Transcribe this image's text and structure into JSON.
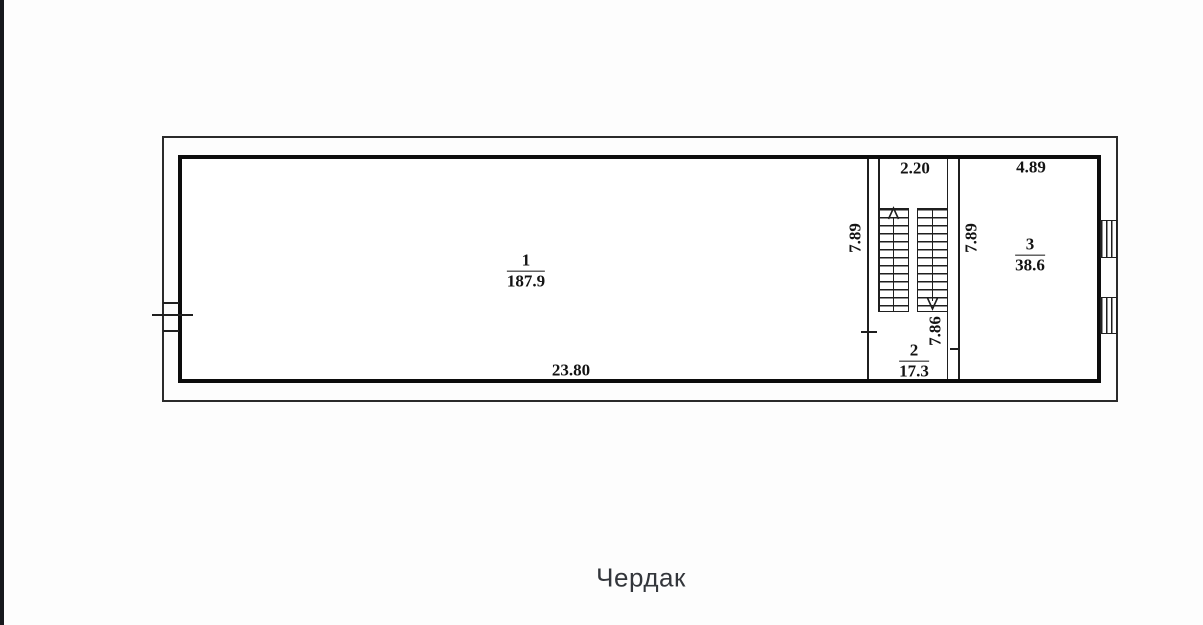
{
  "page": {
    "title_caption": "Чердак"
  },
  "plan": {
    "rooms": [
      {
        "number": "1",
        "area": "187.9"
      },
      {
        "number": "2",
        "area": "17.3"
      },
      {
        "number": "3",
        "area": "38.6"
      }
    ],
    "dimensions": {
      "total_width": "23.80",
      "stair_hall_width": "2.20",
      "room3_width": "4.89",
      "left_depth": "7.89",
      "right_depth": "7.89",
      "room2_depth": "7.86"
    },
    "icons": {
      "stairs_up": "stairs-up-arrow-icon",
      "stairs_down": "stairs-down-arrow-icon",
      "window": "window-symbol"
    },
    "colors": {
      "line": "#1f1f1f",
      "thick_wall": "#0c0c0c",
      "title_text": "#33363b",
      "edge_strip": "#17191d",
      "background": "#fdfdfd"
    }
  }
}
